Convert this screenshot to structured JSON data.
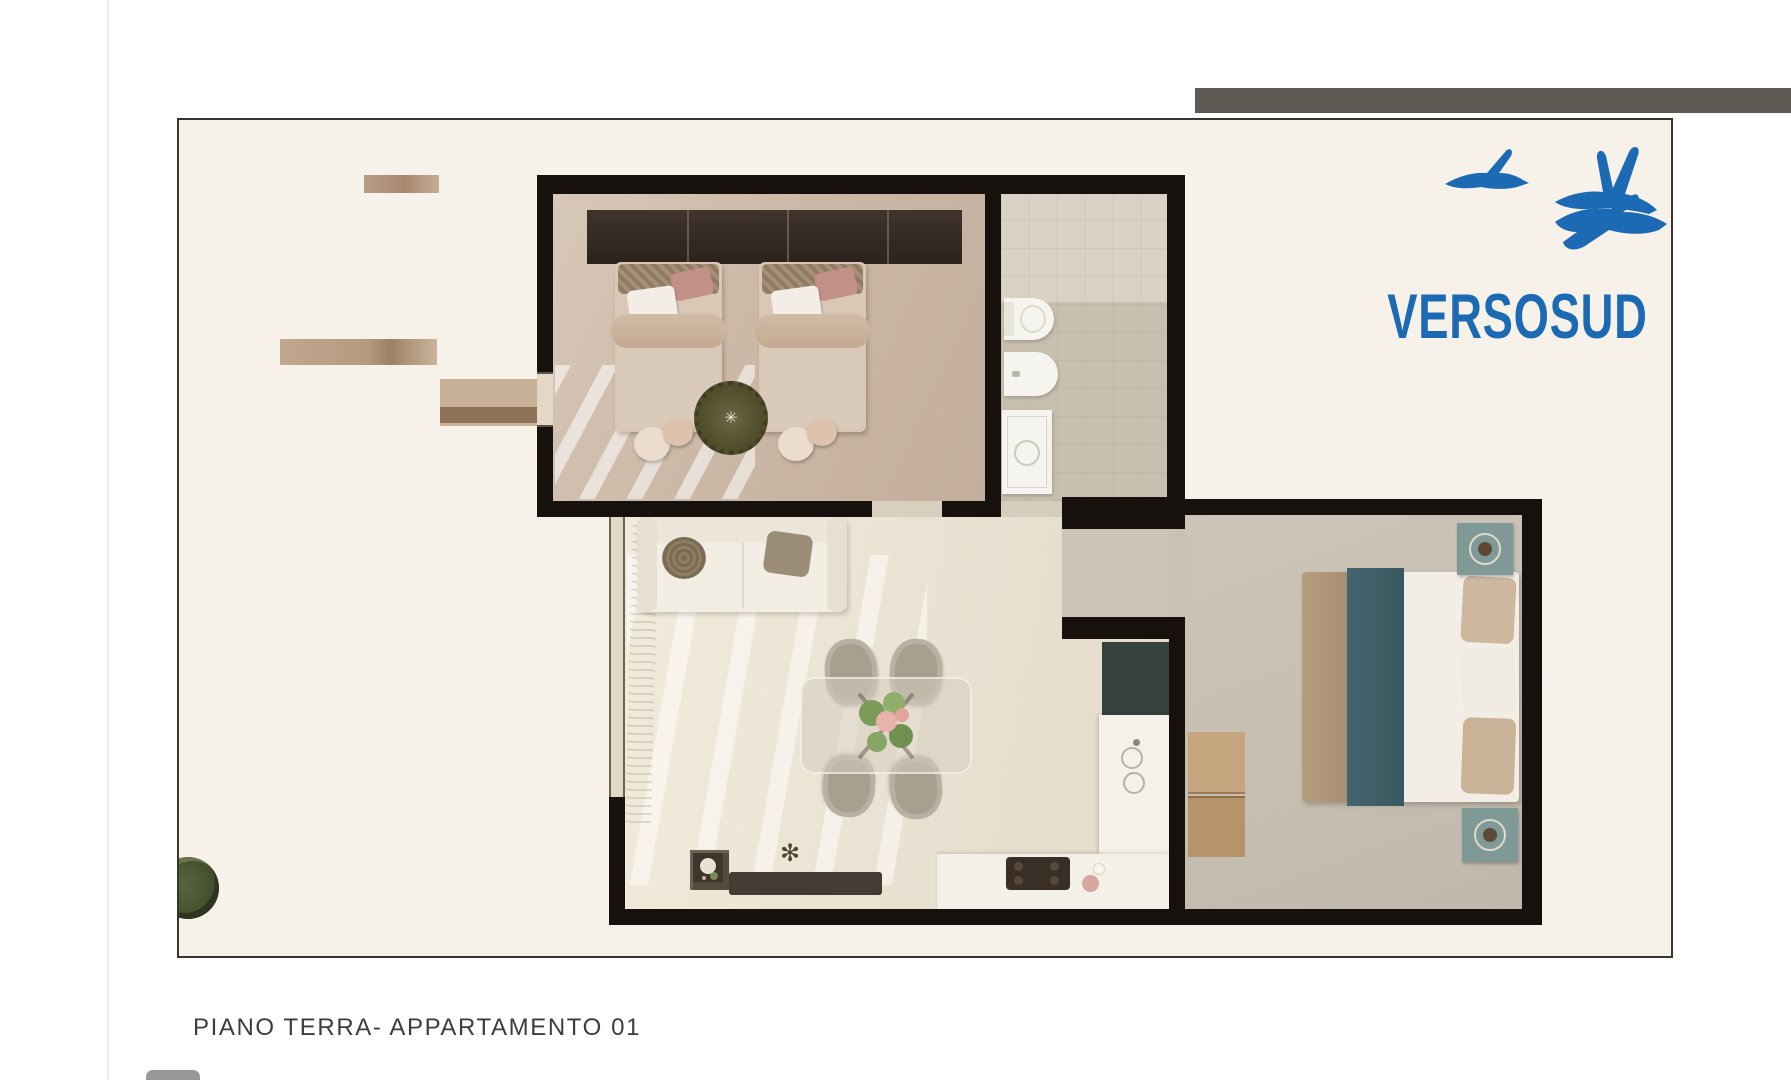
{
  "document": {
    "caption": "PIANO TERRA- APPARTAMENTO 01"
  },
  "logo": {
    "text": "VERSOSUD",
    "brand_color": "#1c69b4",
    "icons": [
      "bird-icon-small",
      "bird-icon-large-upper",
      "bird-icon-large-lower"
    ]
  },
  "plan": {
    "type": "apartment-floor-plan",
    "rooms_visible": 4,
    "palette": {
      "wall": "#16110d",
      "board_background": "#f6f2ea",
      "board_border": "#38352f",
      "bedroom_floor": "#ccb8a7",
      "living_floor": "#e9e1d1",
      "main_bedroom_floor": "#c6bfb1",
      "bathroom_floor": "#c9bfaf",
      "accent_teal": "#3a5860",
      "wood": "#b6946a"
    }
  },
  "artifacts": {
    "top_band_color": "#5d5a53",
    "caption_color": "#3d3d3d"
  }
}
